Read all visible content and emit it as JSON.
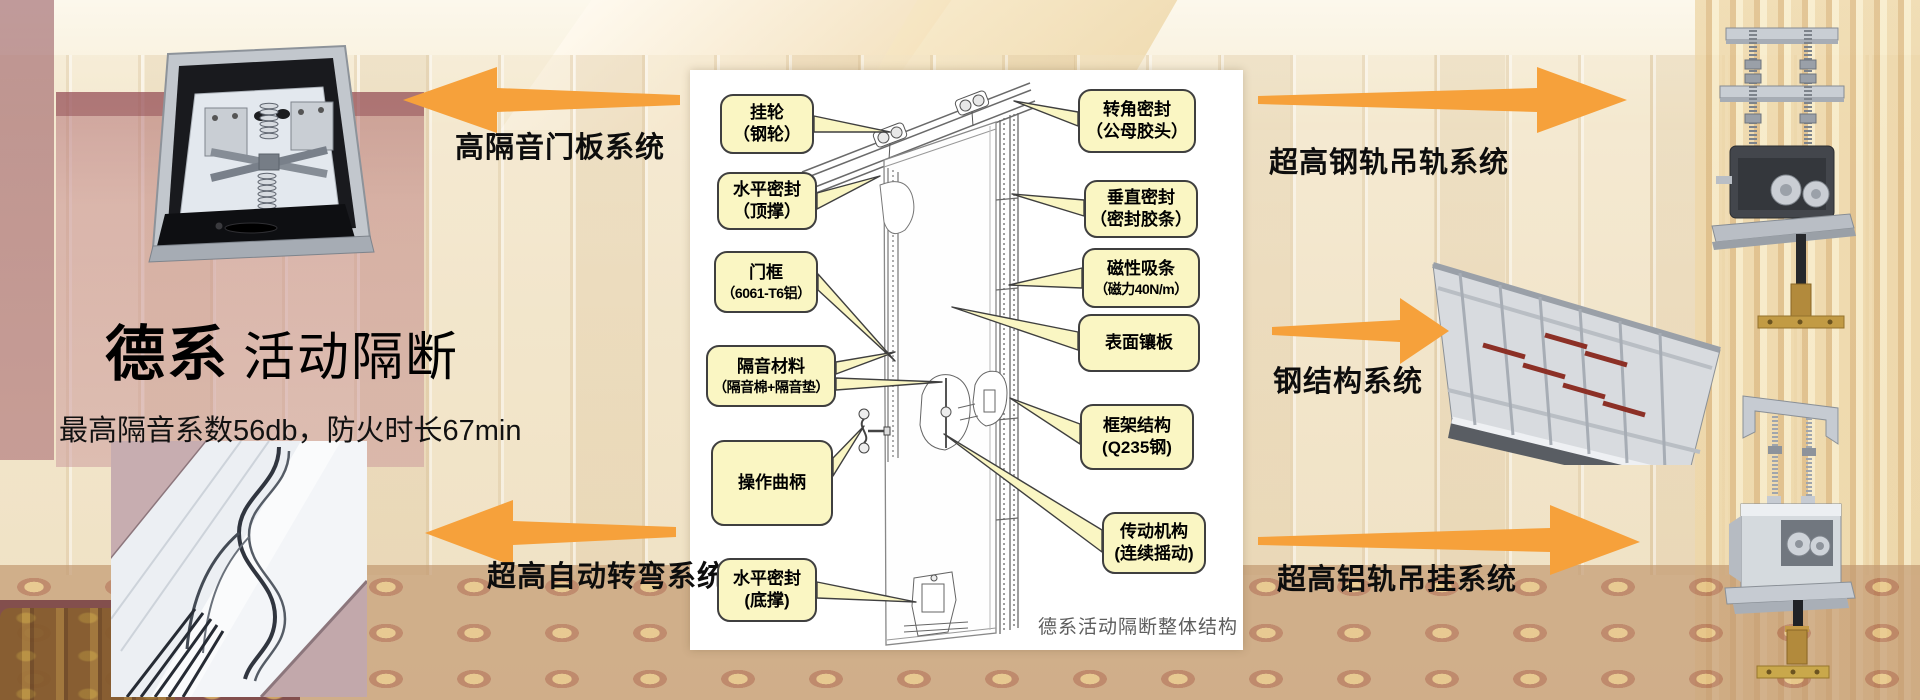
{
  "brand": {
    "title_bold": "德系",
    "title_rest": "活动隔断",
    "subtitle": "最高隔音系数56db，防火时长67min"
  },
  "arrows": [
    {
      "label": "高隔音门板系统"
    },
    {
      "label": "超高自动转弯系统"
    },
    {
      "label": "超高钢轨吊轨系统"
    },
    {
      "label": "钢结构系统"
    },
    {
      "label": "超高铝轨吊挂系统"
    }
  ],
  "diagram": {
    "caption": "德系活动隔断整体结构",
    "left_callouts": [
      {
        "line1": "挂轮",
        "line2": "（钢轮）"
      },
      {
        "line1": "水平密封",
        "line2": "（顶撑）"
      },
      {
        "line1": "门框",
        "line2": "（6061-T6铝）"
      },
      {
        "line1": "隔音材料",
        "line2": "（隔音棉+隔音垫）"
      },
      {
        "line1": "操作曲柄",
        "line2": ""
      },
      {
        "line1": "水平密封",
        "line2": "(底撑)"
      }
    ],
    "right_callouts": [
      {
        "line1": "转角密封",
        "line2": "（公母胶头）"
      },
      {
        "line1": "垂直密封",
        "line2": "（密封胶条）"
      },
      {
        "line1": "磁性吸条",
        "line2": "（磁力40N/m）"
      },
      {
        "line1": "表面镶板",
        "line2": ""
      },
      {
        "line1": "框架结构",
        "line2": "(Q235钢)"
      },
      {
        "line1": "传动机构",
        "line2": "(连续摇动)"
      }
    ]
  },
  "colors": {
    "arrow_orange": "#F6A13B",
    "callout_yellow": "#FAF6C3",
    "callout_border": "#3F3F3F"
  }
}
